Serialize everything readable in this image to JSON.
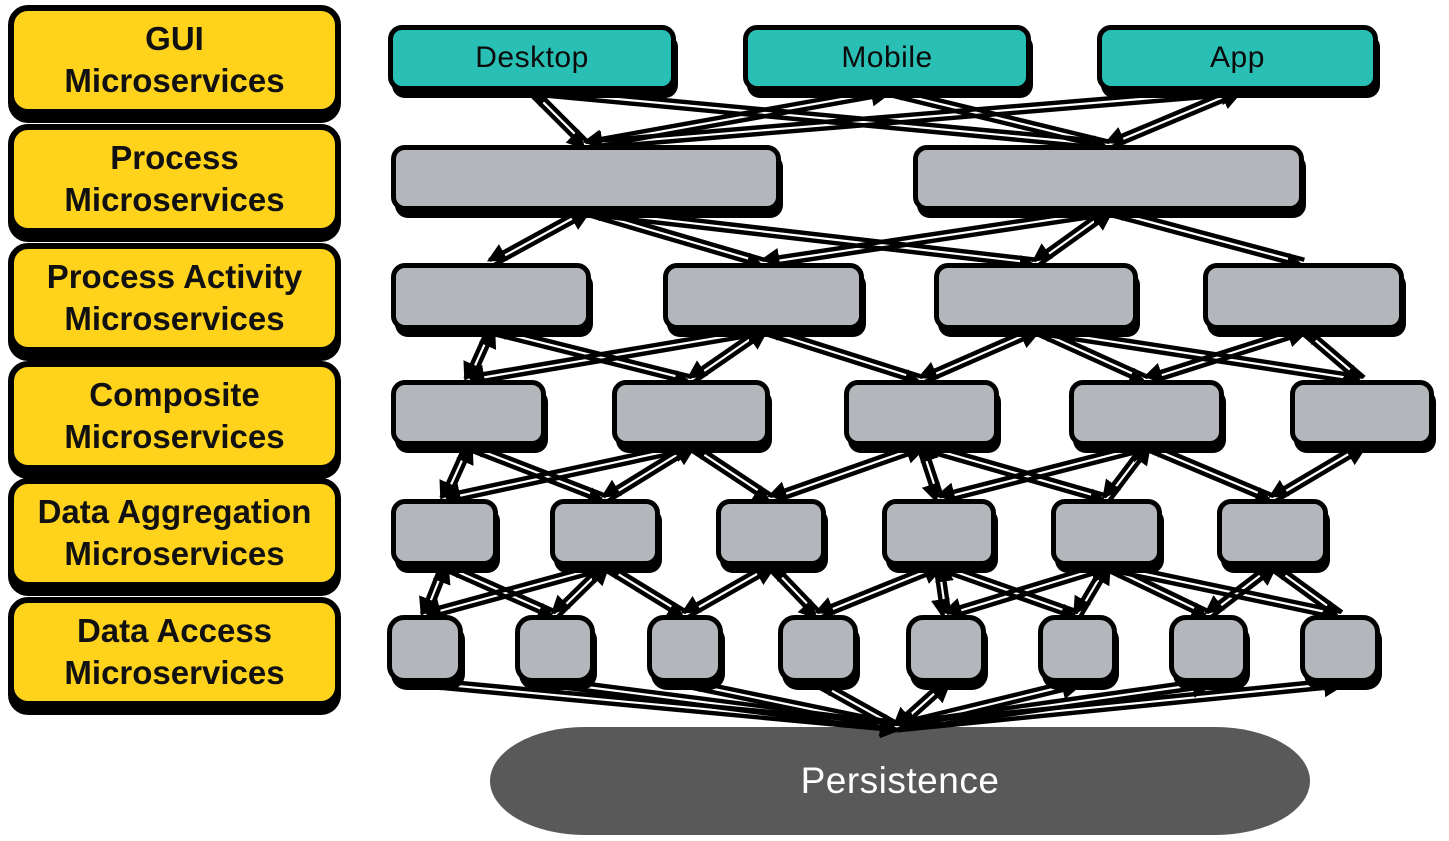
{
  "colors": {
    "layer_label_fill": "#FFD21C",
    "client_fill": "#2ABFB4",
    "service_fill": "#B3B7BB",
    "persistence_fill": "#595959",
    "outline": "#000000",
    "arrow": "#000000",
    "label_text": "#111111",
    "persistence_text": "#ffffff"
  },
  "diagram": {
    "layers": [
      {
        "name": "gui",
        "label": "GUI\nMicroservices",
        "nodes": [
          {
            "id": "desktop",
            "label": "Desktop",
            "kind": "client"
          },
          {
            "id": "mobile",
            "label": "Mobile",
            "kind": "client"
          },
          {
            "id": "app",
            "label": "App",
            "kind": "client"
          }
        ]
      },
      {
        "name": "process",
        "label": "Process\nMicroservices",
        "nodes": [
          {
            "id": "p1",
            "label": "",
            "kind": "service"
          },
          {
            "id": "p2",
            "label": "",
            "kind": "service"
          }
        ]
      },
      {
        "name": "process-activity",
        "label": "Process Activity\nMicroservices",
        "nodes": [
          {
            "id": "a1",
            "label": "",
            "kind": "service"
          },
          {
            "id": "a2",
            "label": "",
            "kind": "service"
          },
          {
            "id": "a3",
            "label": "",
            "kind": "service"
          },
          {
            "id": "a4",
            "label": "",
            "kind": "service"
          }
        ]
      },
      {
        "name": "composite",
        "label": "Composite\nMicroservices",
        "nodes": [
          {
            "id": "c1",
            "label": "",
            "kind": "service"
          },
          {
            "id": "c2",
            "label": "",
            "kind": "service"
          },
          {
            "id": "c3",
            "label": "",
            "kind": "service"
          },
          {
            "id": "c4",
            "label": "",
            "kind": "service"
          },
          {
            "id": "c5",
            "label": "",
            "kind": "service"
          }
        ]
      },
      {
        "name": "data-aggregation",
        "label": "Data Aggregation\nMicroservices",
        "nodes": [
          {
            "id": "d1",
            "label": "",
            "kind": "service"
          },
          {
            "id": "d2",
            "label": "",
            "kind": "service"
          },
          {
            "id": "d3",
            "label": "",
            "kind": "service"
          },
          {
            "id": "d4",
            "label": "",
            "kind": "service"
          },
          {
            "id": "d5",
            "label": "",
            "kind": "service"
          },
          {
            "id": "d6",
            "label": "",
            "kind": "service"
          }
        ]
      },
      {
        "name": "data-access",
        "label": "Data Access\nMicroservices",
        "nodes": [
          {
            "id": "e1",
            "label": "",
            "kind": "service"
          },
          {
            "id": "e2",
            "label": "",
            "kind": "service"
          },
          {
            "id": "e3",
            "label": "",
            "kind": "service"
          },
          {
            "id": "e4",
            "label": "",
            "kind": "service"
          },
          {
            "id": "e5",
            "label": "",
            "kind": "service"
          },
          {
            "id": "e6",
            "label": "",
            "kind": "service"
          },
          {
            "id": "e7",
            "label": "",
            "kind": "service"
          },
          {
            "id": "e8",
            "label": "",
            "kind": "service"
          }
        ]
      }
    ],
    "persistence": {
      "id": "persistence",
      "label": "Persistence"
    },
    "edges_bidirectional": true,
    "edges": [
      [
        "desktop",
        "p1"
      ],
      [
        "desktop",
        "p2"
      ],
      [
        "mobile",
        "p1"
      ],
      [
        "mobile",
        "p2"
      ],
      [
        "app",
        "p1"
      ],
      [
        "app",
        "p2"
      ],
      [
        "p1",
        "a1"
      ],
      [
        "p1",
        "a2"
      ],
      [
        "p1",
        "a3"
      ],
      [
        "p2",
        "a2"
      ],
      [
        "p2",
        "a3"
      ],
      [
        "p2",
        "a4"
      ],
      [
        "a1",
        "c1"
      ],
      [
        "a2",
        "c1"
      ],
      [
        "a1",
        "c2"
      ],
      [
        "a2",
        "c2"
      ],
      [
        "a2",
        "c3"
      ],
      [
        "a3",
        "c3"
      ],
      [
        "a3",
        "c4"
      ],
      [
        "a4",
        "c4"
      ],
      [
        "a3",
        "c5"
      ],
      [
        "a4",
        "c5"
      ],
      [
        "c1",
        "d1"
      ],
      [
        "c2",
        "d1"
      ],
      [
        "c1",
        "d2"
      ],
      [
        "c2",
        "d2"
      ],
      [
        "c2",
        "d3"
      ],
      [
        "c3",
        "d3"
      ],
      [
        "c3",
        "d4"
      ],
      [
        "c4",
        "d4"
      ],
      [
        "c3",
        "d5"
      ],
      [
        "c4",
        "d5"
      ],
      [
        "c4",
        "d6"
      ],
      [
        "c5",
        "d6"
      ],
      [
        "d1",
        "e1"
      ],
      [
        "d2",
        "e1"
      ],
      [
        "d1",
        "e2"
      ],
      [
        "d2",
        "e2"
      ],
      [
        "d2",
        "e3"
      ],
      [
        "d3",
        "e3"
      ],
      [
        "d3",
        "e4"
      ],
      [
        "d4",
        "e4"
      ],
      [
        "d4",
        "e5"
      ],
      [
        "d5",
        "e5"
      ],
      [
        "d4",
        "e6"
      ],
      [
        "d5",
        "e6"
      ],
      [
        "d5",
        "e7"
      ],
      [
        "d6",
        "e7"
      ],
      [
        "d5",
        "e8"
      ],
      [
        "d6",
        "e8"
      ],
      [
        "e1",
        "persistence"
      ],
      [
        "e2",
        "persistence"
      ],
      [
        "e3",
        "persistence"
      ],
      [
        "e4",
        "persistence"
      ],
      [
        "e5",
        "persistence"
      ],
      [
        "e6",
        "persistence"
      ],
      [
        "e7",
        "persistence"
      ],
      [
        "e8",
        "persistence"
      ]
    ]
  }
}
